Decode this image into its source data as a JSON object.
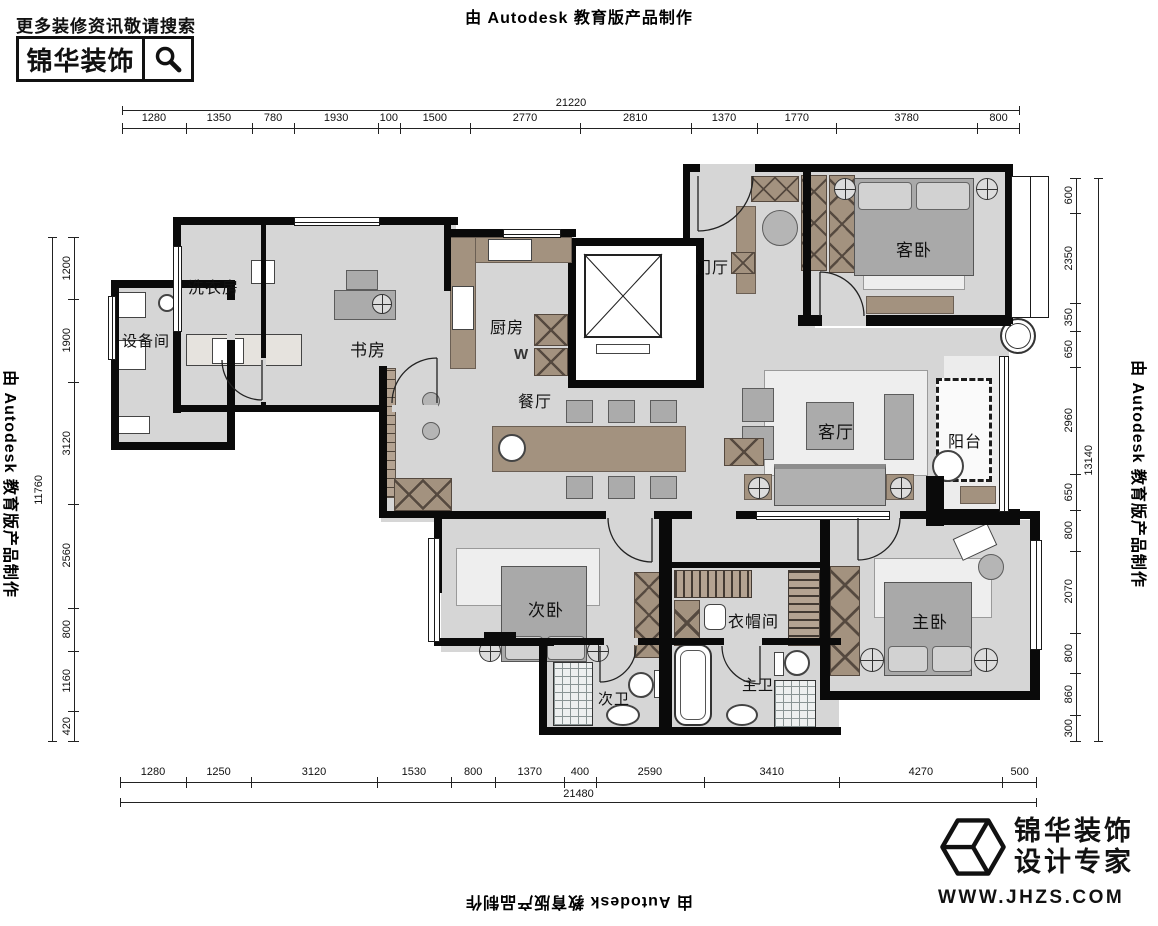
{
  "stamp_text": "由 Autodesk 教育版产品制作",
  "top_left": {
    "hint": "更多装修资讯敬请搜索",
    "brand": "锦华装饰"
  },
  "footer_logo": {
    "line1": "锦华装饰",
    "line2": "设计专家",
    "url": "WWW.JHZS.COM"
  },
  "dimensions": {
    "top": {
      "total": "21220",
      "segments": [
        "1280",
        "1350",
        "780",
        "1930",
        "100",
        "1500",
        "2770",
        "2810",
        "1370",
        "1770",
        "3780",
        "800"
      ]
    },
    "bottom": {
      "total": "21480",
      "segments": [
        "1280",
        "1250",
        "3120",
        "1530",
        "800",
        "1370",
        "400",
        "2590",
        "3410",
        "4270",
        "500"
      ]
    },
    "left": {
      "total": "11760",
      "segments": [
        "1200",
        "1900",
        "3120",
        "2560",
        "800",
        "1160",
        "420"
      ]
    },
    "right": {
      "total": "13140",
      "segments": [
        "600",
        "2350",
        "350",
        "650",
        "2960",
        "650",
        "800",
        "2070",
        "800",
        "860",
        "300"
      ]
    }
  },
  "rooms": {
    "laundry": "洗衣房",
    "equipment": "设备间",
    "study": "书房",
    "kitchen": "厨房",
    "entry": "门厅",
    "guest_bedroom": "客卧",
    "dining": "餐厅",
    "living": "客厅",
    "balcony": "阳台",
    "second_bedroom": "次卧",
    "cloakroom": "衣帽间",
    "master_bedroom": "主卧",
    "second_bath": "次卫",
    "master_bath": "主卫"
  },
  "marks": {
    "kitchen_w": "W"
  },
  "colors": {
    "wall": "#0a0a0a",
    "floor": "#d6d6d6",
    "floor_light": "#ececec",
    "furniture": "#a3927f",
    "furniture_dark": "#55493f",
    "text": "#111111"
  }
}
